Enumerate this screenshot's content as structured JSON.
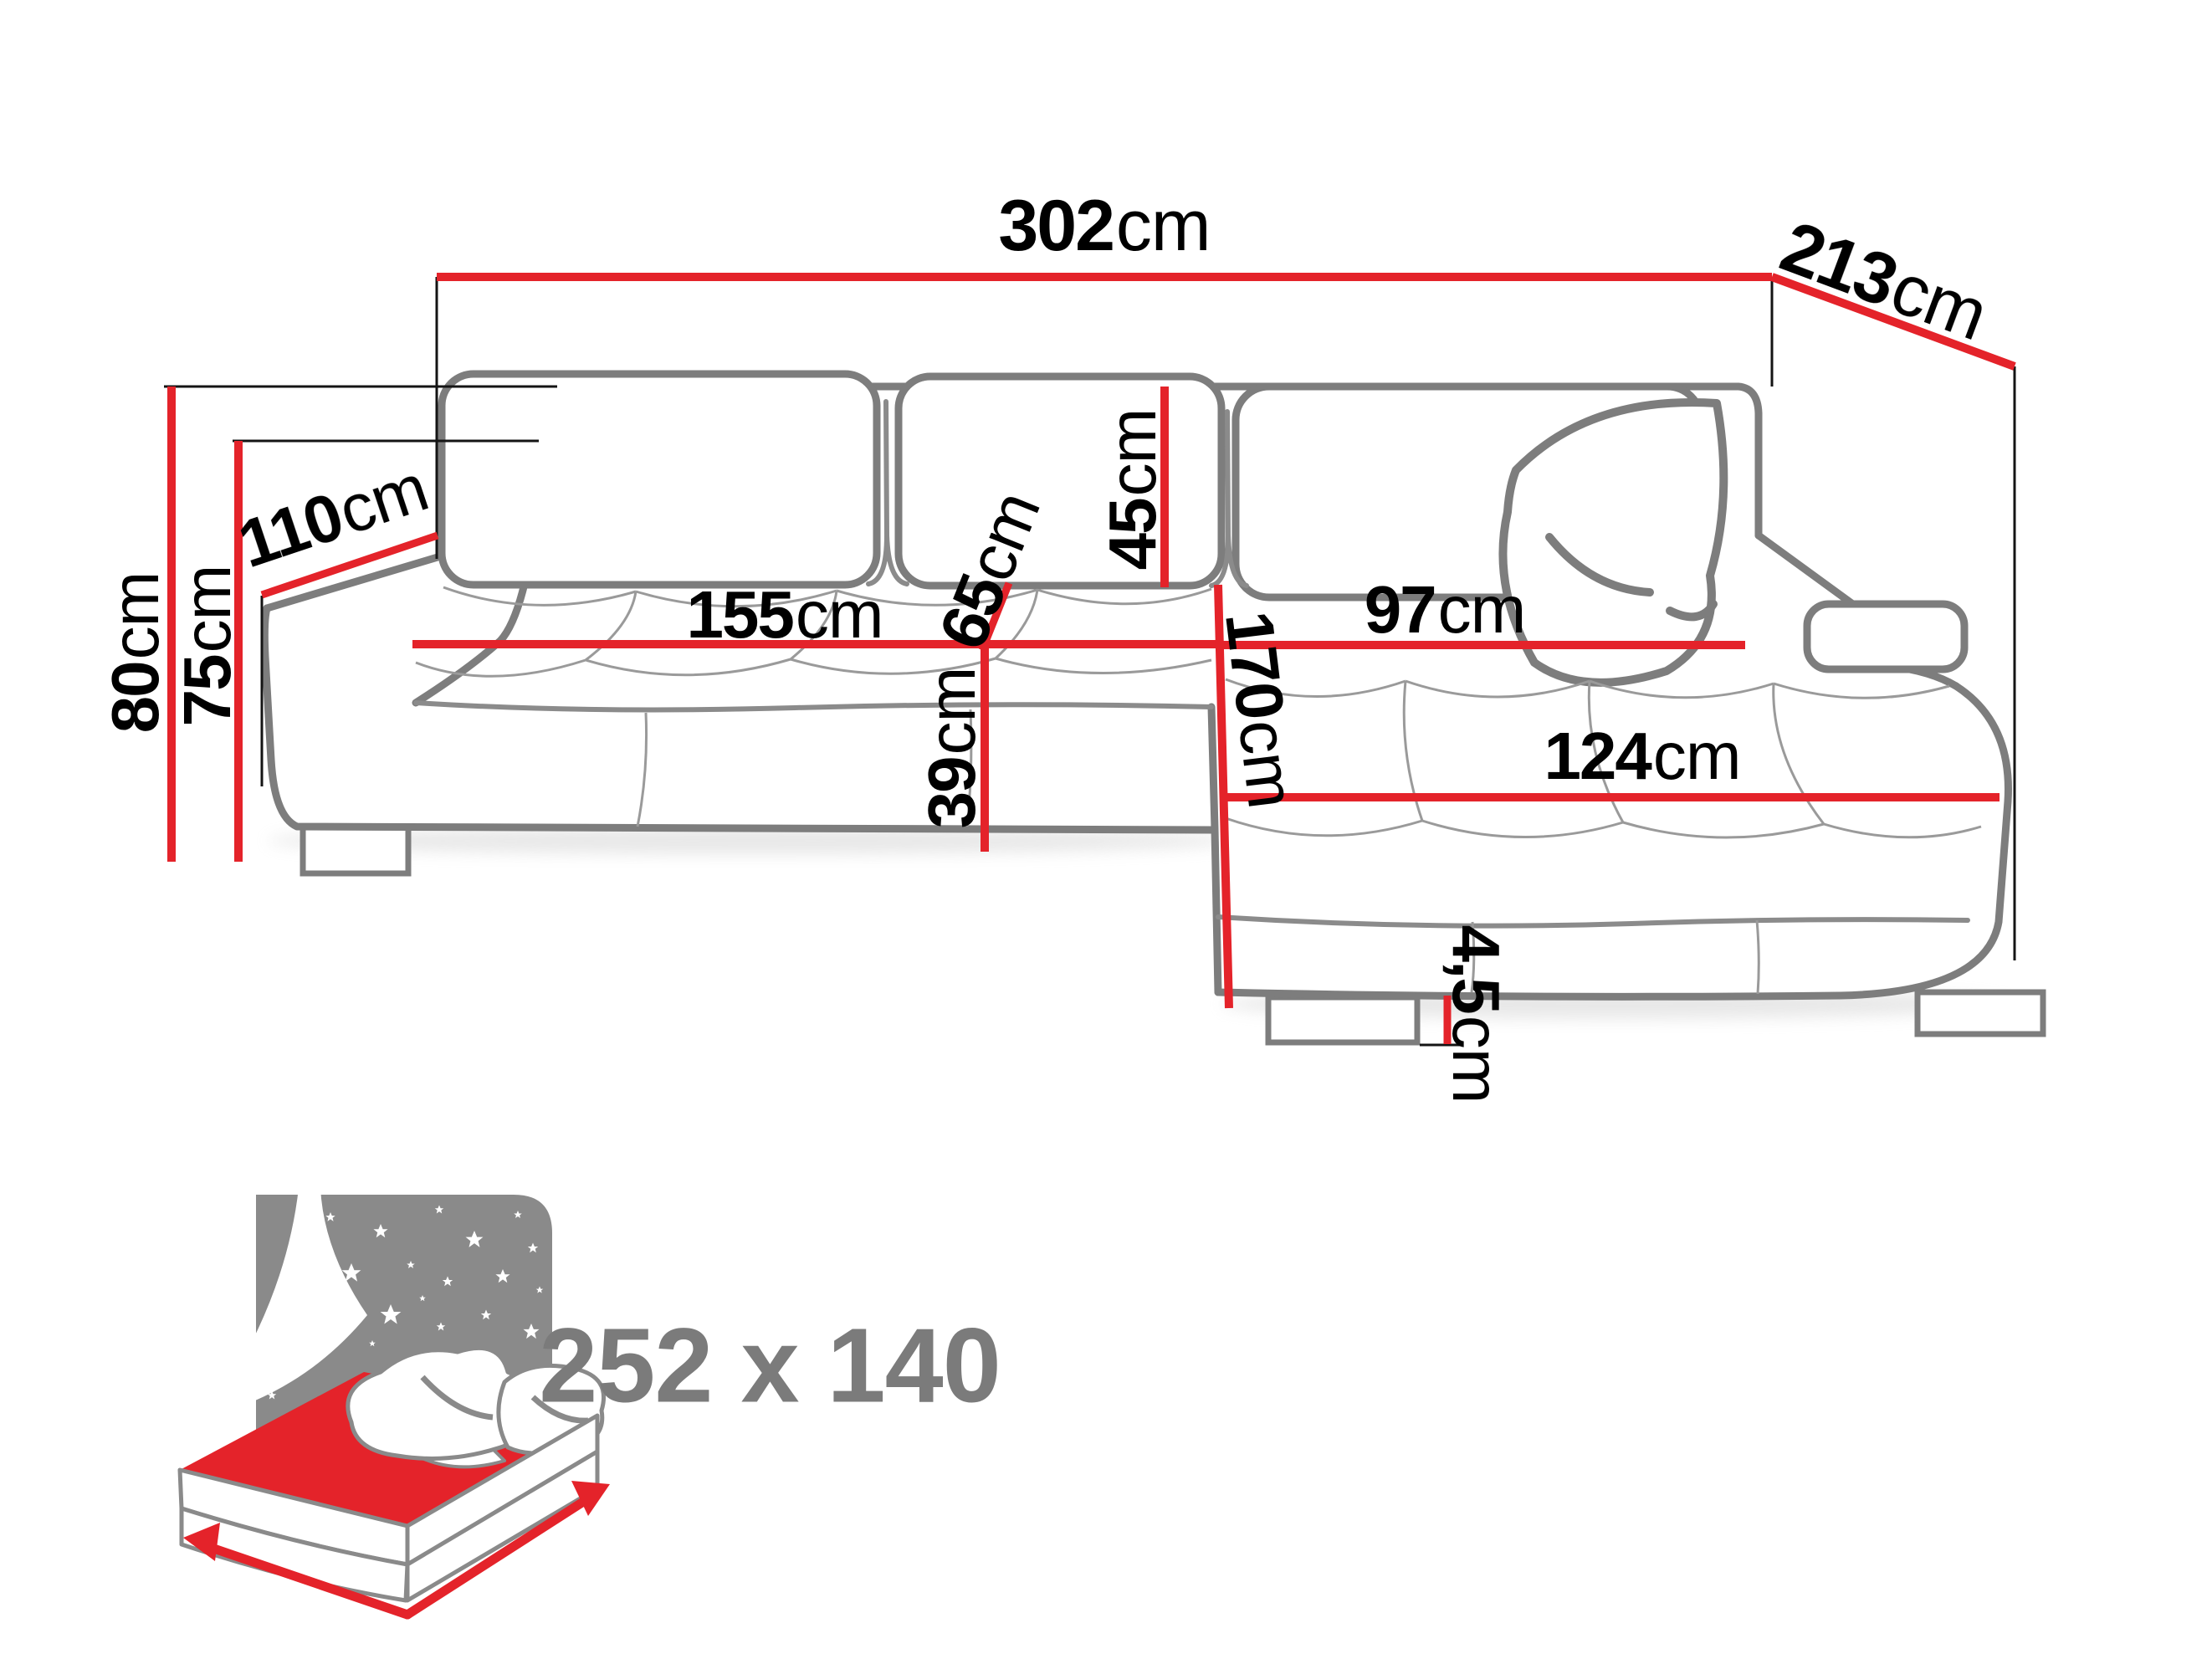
{
  "diagram_title": "corner sofa dimensions diagram",
  "dims": {
    "d302": {
      "num": "302",
      "unit": "cm"
    },
    "d213": {
      "num": "213",
      "unit": "cm"
    },
    "d80": {
      "num": "80",
      "unit": "cm"
    },
    "d75": {
      "num": "75",
      "unit": "cm"
    },
    "d110": {
      "num": "110",
      "unit": "cm"
    },
    "d155": {
      "num": "155",
      "unit": "cm"
    },
    "d65": {
      "num": "65",
      "unit": "cm"
    },
    "d45": {
      "num": "45",
      "unit": "cm"
    },
    "d170": {
      "num": "170",
      "unit": "cm"
    },
    "d97": {
      "num": "97",
      "unit": "cm"
    },
    "d124": {
      "num": "124",
      "unit": "cm"
    },
    "d39": {
      "num": "39",
      "unit": "cm"
    },
    "d4_5": {
      "num": "4,5",
      "unit": "cm"
    },
    "unit_label": "cm"
  },
  "sleeping_area": {
    "size": "252 x 140"
  },
  "icons": {
    "sleeping_icon": "bed-with-starry-night-icon"
  },
  "colors": {
    "dimension_red": "#e4232a",
    "sofa_outline_gray": "#7d7d7d",
    "seam_gray": "#9a9a9a",
    "icon_gray": "#8a8a8a",
    "text_black": "#000000",
    "muted_text_gray": "#7b7b7b"
  }
}
